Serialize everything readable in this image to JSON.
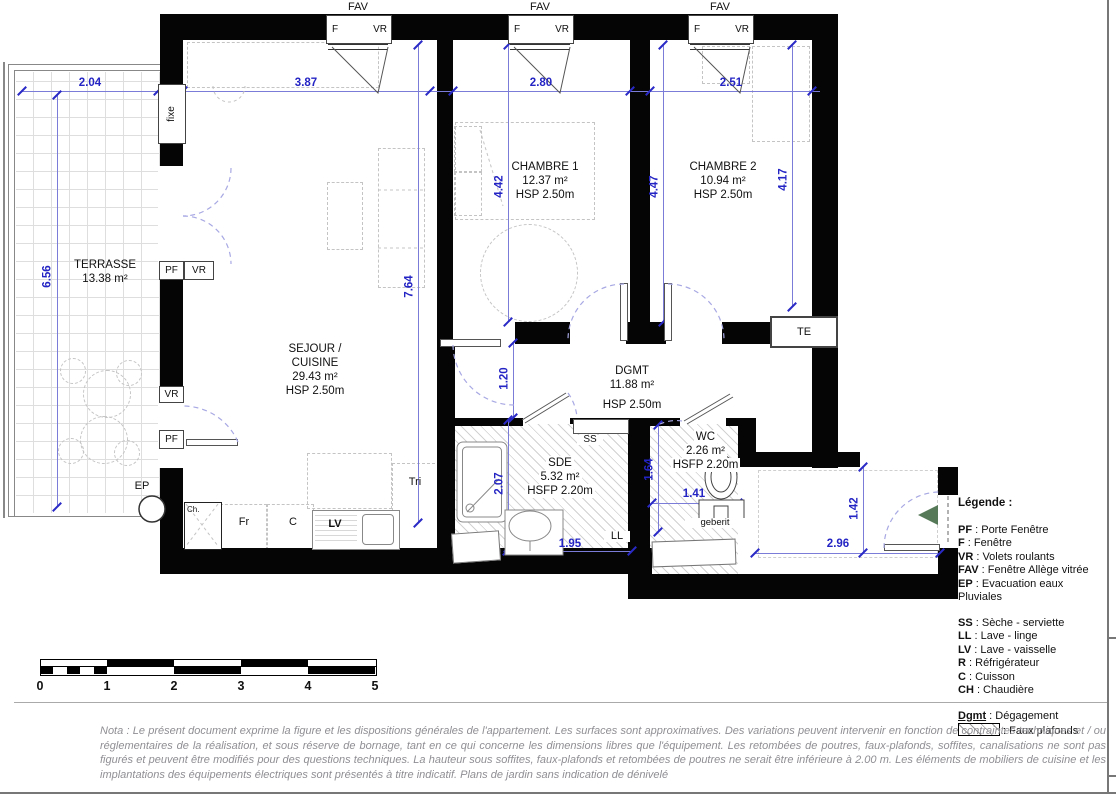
{
  "plan": {
    "windows": {
      "fav": "FAV",
      "f": "F",
      "vr": "VR",
      "fixe": "fixe",
      "pf": "PF",
      "ep": "EP",
      "te": "TE"
    },
    "rooms": {
      "terrasse": {
        "name": "TERRASSE",
        "area": "13.38 m²"
      },
      "sejour": {
        "name1": "SEJOUR /",
        "name2": "CUISINE",
        "area": "29.43 m²",
        "height": "HSP 2.50m"
      },
      "chambre1": {
        "name": "CHAMBRE 1",
        "area": "12.37 m²",
        "height": "HSP 2.50m"
      },
      "chambre2": {
        "name": "CHAMBRE 2",
        "area": "10.94 m²",
        "height": "HSP 2.50m"
      },
      "dgmt": {
        "name": "DGMT",
        "area": "11.88 m²",
        "height": "HSP 2.50m"
      },
      "sde": {
        "name": "SDE",
        "area": "5.32 m²",
        "height": "HSFP 2.20m"
      },
      "wc": {
        "name": "WC",
        "area": "2.26 m²",
        "height": "HSFP 2.20m"
      }
    },
    "dims": {
      "terrasse_w": "2.04",
      "terrasse_h": "6.56",
      "sejour_w": "3.87",
      "sejour_h": "7.64",
      "chambre1_w": "2.80",
      "chambre1_h": "4.42",
      "chambre1_h2": "4.47",
      "chambre2_w": "2.51",
      "chambre2_h": "4.17",
      "degagement_w": "1.20",
      "sde_h": "2.07",
      "sde_w": "1.95",
      "wc_h": "1.64",
      "wc_w": "1.41",
      "entree_h": "1.42",
      "entree_w": "2.96"
    },
    "equipment": {
      "ss": "SS",
      "ll": "LL",
      "lv": "LV",
      "fr": "Fr",
      "c": "C",
      "ch": "Ch.",
      "tri": "Tri",
      "geberit": "geberit"
    }
  },
  "legend": {
    "title": "Légende :",
    "items_windows": [
      {
        "key": "PF",
        "label": " : Porte Fenêtre"
      },
      {
        "key": "F",
        "label": " : Fenêtre"
      },
      {
        "key": "VR",
        "label": " : Volets roulants"
      },
      {
        "key": "FAV",
        "label": " : Fenêtre Allège vitrée"
      },
      {
        "key": "EP",
        "label": " : Evacuation eaux Pluviales"
      }
    ],
    "items_equipment": [
      {
        "key": "SS",
        "label": " : Sèche - serviette"
      },
      {
        "key": "LL",
        "label": " : Lave - linge"
      },
      {
        "key": "LV",
        "label": " : Lave - vaisselle"
      },
      {
        "key": "R",
        "label": " : Réfrigérateur"
      },
      {
        "key": "C",
        "label": " : Cuisson"
      },
      {
        "key": "CH",
        "label": " : Chaudière"
      }
    ],
    "dgmt": {
      "key": "Dgmt",
      "label": " : Dégagement"
    },
    "faux_plafonds": " : Faux plafonds"
  },
  "scalebar": {
    "labels": [
      "0",
      "1",
      "2",
      "3",
      "4",
      "5"
    ]
  },
  "nota": "Nota : Le présent document exprime la figure et les dispositions générales de l'appartement. Les surfaces sont approximatives. Des variations peuvent intervenir en fonction de contraintes techniques et / ou réglementaires de la réalisation, et sous réserve de bornage, tant en ce qui concerne les dimensions libres que l'équipement. Les retombées de poutres, faux-plafonds, soffites, canalisations ne sont pas figurés et peuvent être modifiés pour des questions techniques. La hauteur sous soffites, faux-plafonds et retombées de poutres ne serait être inférieure à 2.00 m. Les éléments de mobiliers de cuisine et les implantations des équipements électriques sont présentés à titre indicatif. Plans de jardin sans indication de dénivelé",
  "colors": {
    "dimension_blue": "#2424c4",
    "wall_black": "#050505",
    "entry_arrow_green": "#567a57"
  }
}
